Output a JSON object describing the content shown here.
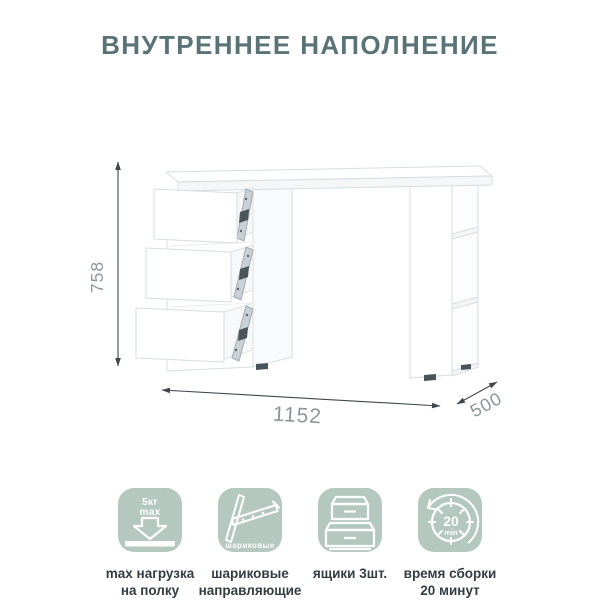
{
  "title": "ВНУТРЕННЕЕ НАПОЛНЕНИЕ",
  "diagram": {
    "height_label": "758",
    "width_label": "1152",
    "depth_label": "500"
  },
  "features": [
    {
      "badge_top": "5кг",
      "badge_bottom": "max",
      "caption1": "max нагрузка",
      "caption2": "на полку"
    },
    {
      "badge_label": "шариковые",
      "caption1": "шариковые",
      "caption2": "направляющие"
    },
    {
      "caption1": "ящики 3шт.",
      "caption2": ""
    },
    {
      "badge_top": "20",
      "badge_bottom": "min",
      "caption1": "время сборки",
      "caption2": "20 минут"
    }
  ],
  "colors": {
    "title_text": "#5a7377",
    "caption_text": "#323d43",
    "tile_background": "#b5c8c0",
    "dimension_text": "#8d979b",
    "dimension_line": "#3e484d"
  }
}
